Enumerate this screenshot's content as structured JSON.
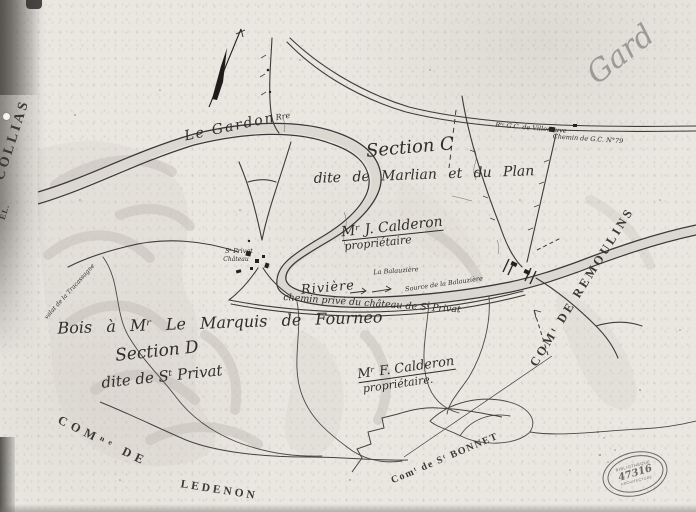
{
  "colors": {
    "paper": "#eae7e1",
    "ink": "#3d3b37",
    "pencil": "#9b9a97",
    "scan_edge": "#565450"
  },
  "annotations": {
    "gard": "Gard"
  },
  "labels": {
    "collias": "COLLIAS",
    "edge_fragment": "EL.",
    "le_gardon": "Le Gardon",
    "gardon_sup": "Rre",
    "route_villeneuve": "Rᵗᵉ G.C. de Villeneuve",
    "chemin_gc": "Chemin de G.C. N°79",
    "section_c": "Section C",
    "section_c_sub": "dite de Marlian et du Plan",
    "owner1_name": "Mʳ J. Calderon",
    "owner1_role": "propriétaire",
    "la_balauziere": "La Balauzière",
    "source_balauziere": "Source de la Balauzière",
    "riviere": "Rivière",
    "chemin_prive": "chemin privé du château de Sᵗ Privat",
    "bois": "Bois à Mʳ Le Marquis de Fourneo",
    "section_d": "Section D",
    "section_d_sub": "dite de Sᵗ Privat",
    "owner2_name": "Mʳ F. Calderon",
    "owner2_role": "propriétaire.",
    "chateau_line1": "Sᵗ Privat",
    "chateau_line2": "Château",
    "valat": "valat de la Tracassagne",
    "com_remoulins": "COMᵗ DE REMOULINS",
    "com_ledenon_1": "COMⁿᵉ DE",
    "com_ledenon_2": "LEDENON",
    "com_st_bonnet": "Comᵗ de Sᵗ BONNET"
  },
  "stamp": {
    "top": "BIBLIOTHÈQUE",
    "number": "47316",
    "bottom": "ARCHITECTURE"
  },
  "icons": {
    "north_arrow": "compass-north-arrow",
    "flow_arrow": "river-flow-arrow",
    "bridge": "bridge-hatches",
    "buildings": "chateau-buildings"
  }
}
